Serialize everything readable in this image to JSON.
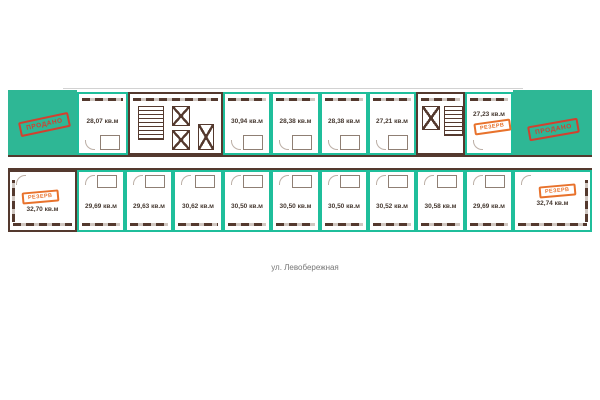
{
  "colors": {
    "teal_fill": "#2EB795",
    "teal_border": "#1FBE9B",
    "wall_brown": "#54392E",
    "stamp_red": "#D2402F",
    "stamp_orange": "#E8722C",
    "area_text": "#463931",
    "street_text": "#777777"
  },
  "stamps": {
    "sold": "ПРОДАНО",
    "reserve": "РЕЗЕРВ"
  },
  "street_label": "ул. Левобережная",
  "sold_blocks": [
    {
      "label": "ПРОДАНО",
      "position": "top-left"
    },
    {
      "label": "ПРОДАНО",
      "position": "top-right"
    }
  ],
  "units_top": [
    {
      "area": "28,07 кв.м",
      "status": "available"
    },
    {
      "area": "30,94 кв.м",
      "status": "available"
    },
    {
      "area": "28,38 кв.м",
      "status": "available"
    },
    {
      "area": "28,38 кв.м",
      "status": "available"
    },
    {
      "area": "27,21 кв.м",
      "status": "available"
    },
    {
      "area": "27,23 кв.м",
      "status": "reserved"
    }
  ],
  "units_bottom": [
    {
      "area": "32,70 кв.м",
      "status": "reserved"
    },
    {
      "area": "29,69 кв.м",
      "status": "available"
    },
    {
      "area": "29,63 кв.м",
      "status": "available"
    },
    {
      "area": "30,62 кв.м",
      "status": "available"
    },
    {
      "area": "30,50 кв.м",
      "status": "available"
    },
    {
      "area": "30,50 кв.м",
      "status": "available"
    },
    {
      "area": "30,50 кв.м",
      "status": "available"
    },
    {
      "area": "30,52 кв.м",
      "status": "available"
    },
    {
      "area": "30,58 кв.м",
      "status": "available"
    },
    {
      "area": "29,69 кв.м",
      "status": "available"
    },
    {
      "area": "32,74 кв.м",
      "status": "reserved"
    }
  ]
}
